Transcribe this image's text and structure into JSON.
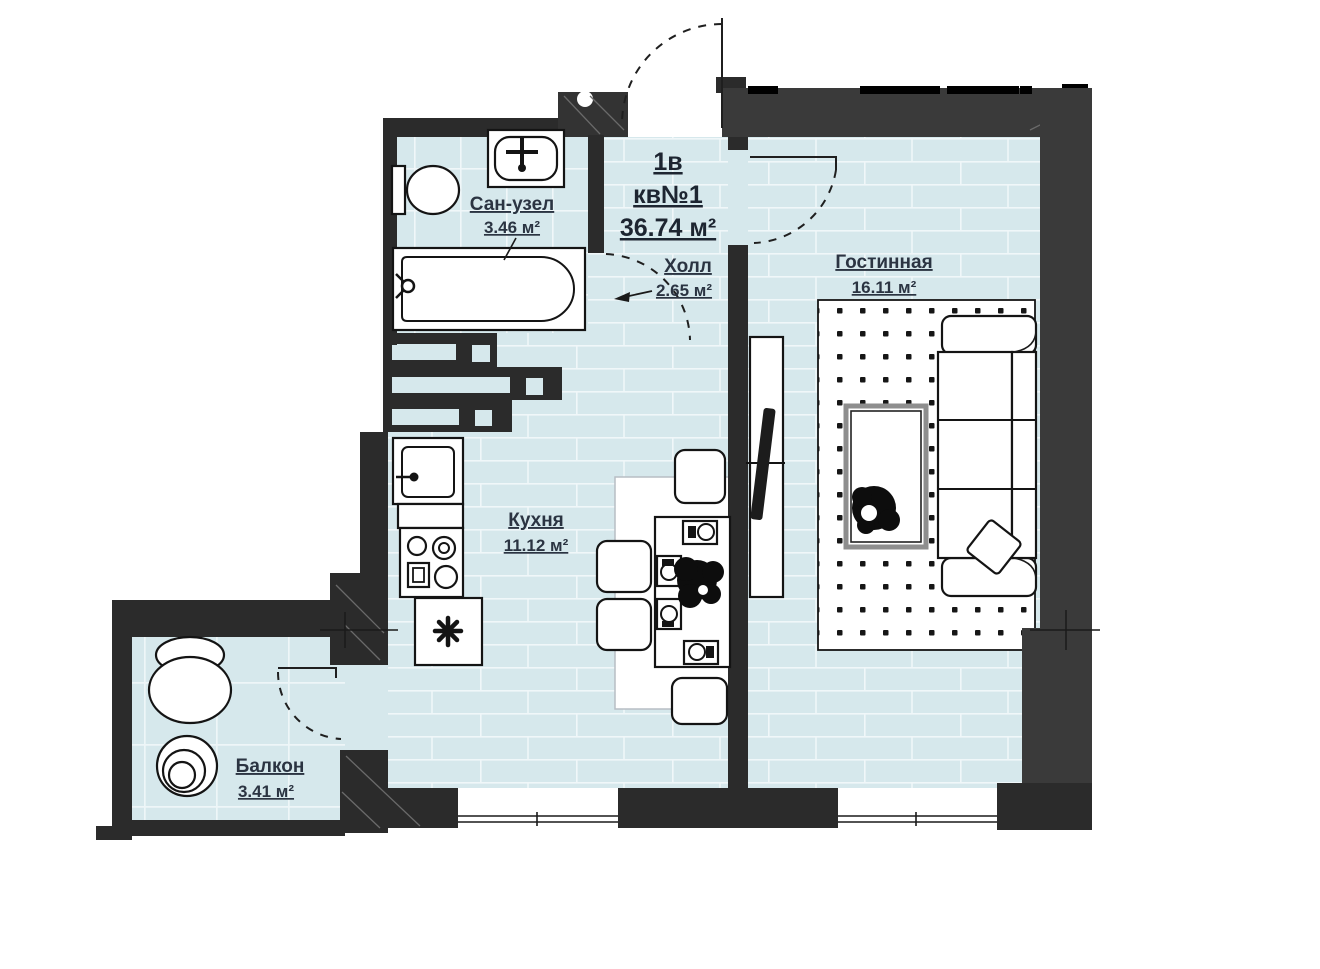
{
  "title": {
    "line1": "1в",
    "line2": "кв№1",
    "line3": "36.74 м²"
  },
  "rooms": {
    "bathroom": {
      "name": "Сан-узел",
      "area": "3.46 м²"
    },
    "hall": {
      "name": "Холл",
      "area": "2.65 м²"
    },
    "living": {
      "name": "Гостинная",
      "area": "16.11 м²"
    },
    "kitchen": {
      "name": "Кухня",
      "area": "11.12 м²"
    },
    "balcony": {
      "name": "Балкон",
      "area": "3.41 м²"
    }
  },
  "colors": {
    "floor": "#d6e8ec",
    "wall_inner": "#2b2b2b",
    "wall_outer": "#3a3a3a",
    "carpet_dot": "#161616",
    "label_text": "#2b3442"
  }
}
